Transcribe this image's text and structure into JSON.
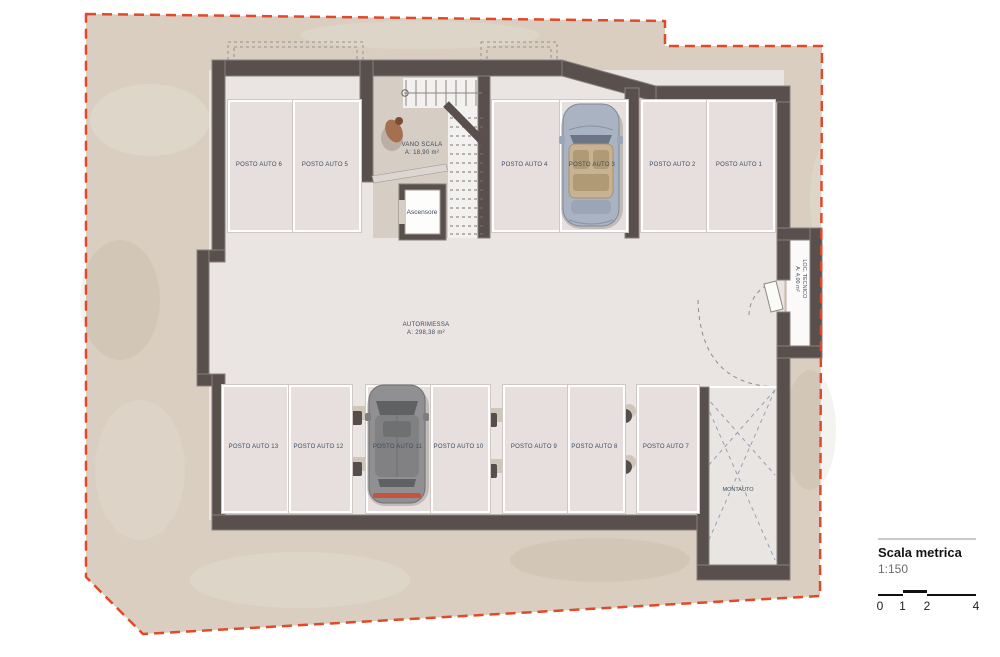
{
  "plan": {
    "rooms": {
      "autorimessa": {
        "name": "AUTORIMESSA",
        "area": "A: 298,38 m²"
      },
      "vano_scala": {
        "name": "VANO SCALA",
        "area": "A: 18,90 m²"
      },
      "ascensore": {
        "name": "Ascensore"
      },
      "loc_tecnico": {
        "name": "LOC. TECNICO",
        "area": "A: 4,00 m²"
      },
      "montauto": {
        "name": "MONTAUTO"
      }
    },
    "parking": {
      "top": [
        "POSTO AUTO 6",
        "POSTO AUTO 5",
        "POSTO AUTO 4",
        "POSTO AUTO 3",
        "POSTO AUTO 2",
        "POSTO AUTO 1"
      ],
      "bottom": [
        "POSTO AUTO 13",
        "POSTO AUTO 12",
        "POSTO AUTO 11",
        "POSTO AUTO 10",
        "POSTO AUTO 9",
        "POSTO AUTO 8",
        "POSTO AUTO 7"
      ]
    },
    "colors": {
      "boundary_red": "#e0492b",
      "wall": "#59504d",
      "floor": "#eae4e2",
      "terrain": "#d9cec0",
      "label_text": "#3c4c60"
    }
  },
  "legend": {
    "title": "Scala metrica",
    "scale": "1:150",
    "ticks": [
      "0",
      "1",
      "2",
      "4"
    ]
  }
}
